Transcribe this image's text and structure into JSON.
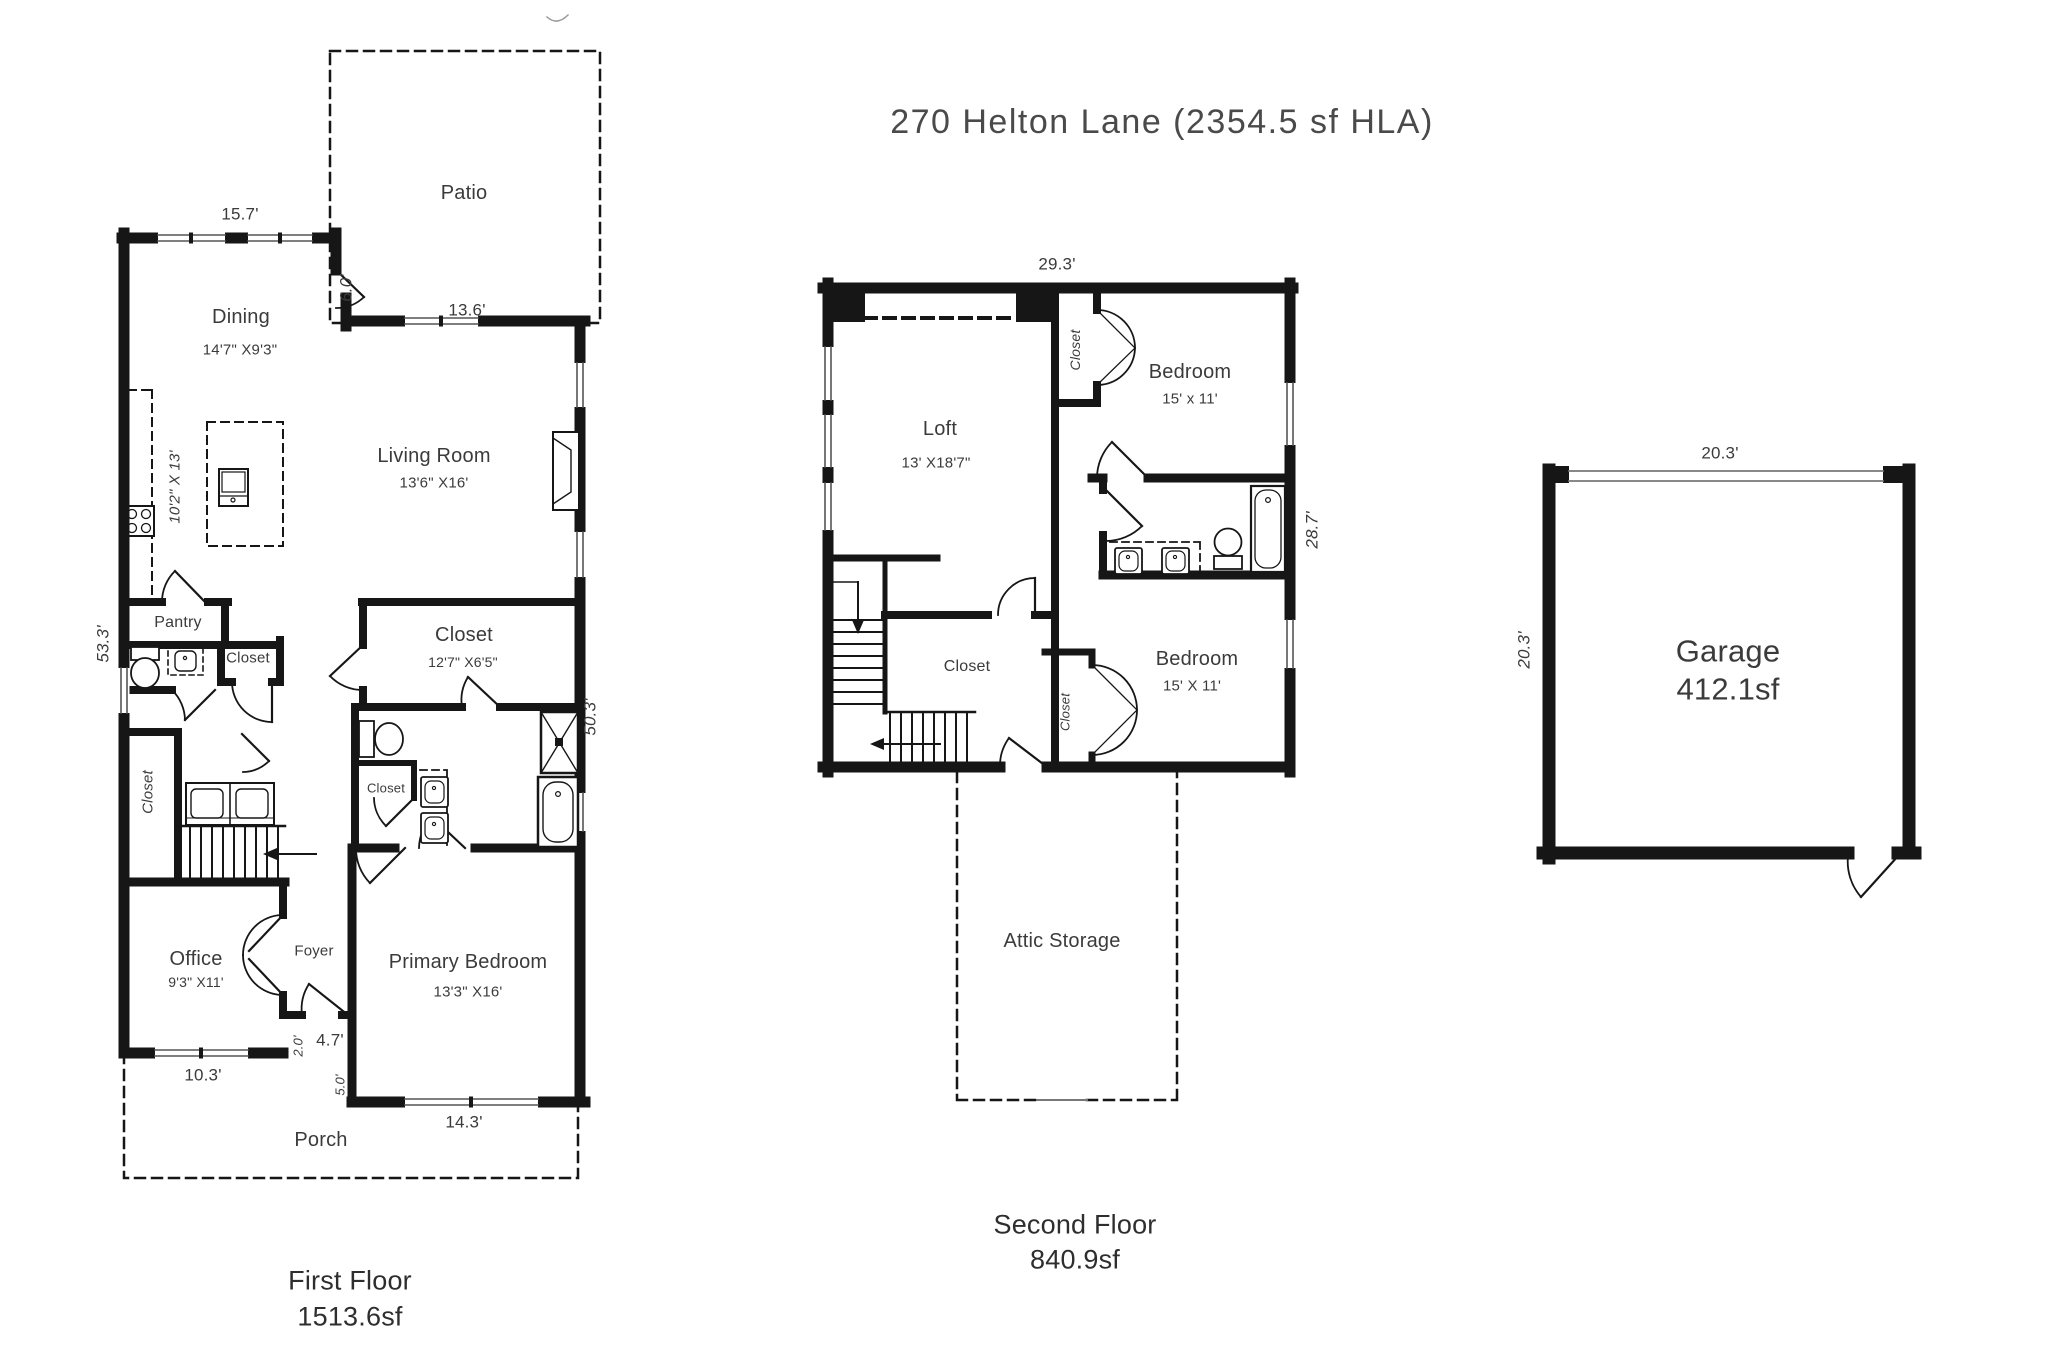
{
  "title": "270 Helton Lane (2354.5 sf HLA)",
  "first": {
    "caption": "First Floor",
    "area": "1513.6sf",
    "patio": "Patio",
    "dining": "Dining",
    "dining_size": "14'7\" X9'3\"",
    "kitchen_size": "10'2\" X 13'",
    "living": "Living Room",
    "living_size": "13'6\" X16'",
    "pantry": "Pantry",
    "closet_half_bath": "Closet",
    "closet_laundry": "Closet",
    "closet_walkin": "Closet",
    "closet_walkin_size": "12'7\" X6'5\"",
    "closet_primary_bath": "Closet",
    "office": "Office",
    "office_size": "9'3\" X11'",
    "foyer": "Foyer",
    "primary_bedroom": "Primary Bedroom",
    "primary_size": "13'3\" X16'",
    "porch": "Porch",
    "dims": {
      "top": "15.7'",
      "patio_door": "6.0'",
      "living_window": "13.6'",
      "left_side": "53.3'",
      "right_side": "50.3'",
      "office_front": "10.3'",
      "entry_jog": "2.0'",
      "entry": "4.7'",
      "porch_depth": "5.0'",
      "bedroom_front": "14.3'"
    }
  },
  "second": {
    "caption": "Second Floor",
    "area": "840.9sf",
    "loft": "Loft",
    "loft_size": "13' X18'7\"",
    "bedroom1": "Bedroom",
    "bedroom1_size": "15' x 11'",
    "bedroom2": "Bedroom",
    "bedroom2_size": "15' X 11'",
    "closet_top": "Closet",
    "closet_hall": "Closet",
    "closet_small": "Closet",
    "attic": "Attic Storage",
    "dims": {
      "top": "29.3'",
      "right_side": "28.7'"
    }
  },
  "garage": {
    "name": "Garage",
    "area": "412.1sf",
    "dims": {
      "top": "20.3'",
      "left_side": "20.3'"
    }
  }
}
